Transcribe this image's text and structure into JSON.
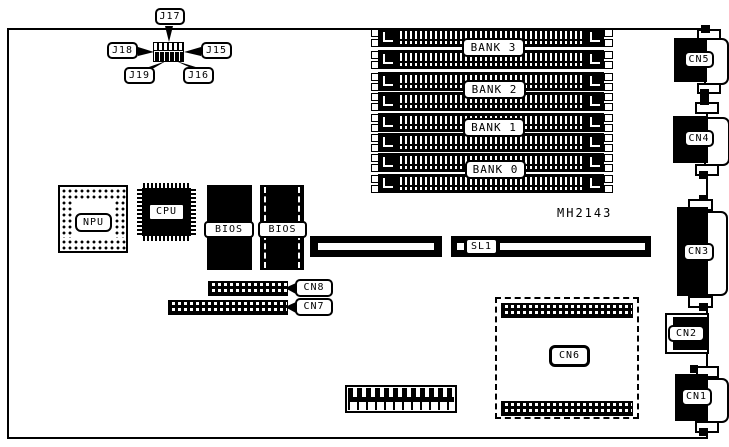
{
  "board": {
    "part_number": "MH2143",
    "jumpers": {
      "j15": "J15",
      "j16": "J16",
      "j17": "J17",
      "j18": "J18",
      "j19": "J19"
    },
    "chips": {
      "npu": "NPU",
      "cpu": "CPU",
      "bios_left": "BIOS",
      "bios_right": "BIOS"
    },
    "memory": {
      "bank0": "BANK 0",
      "bank1": "BANK 1",
      "bank2": "BANK 2",
      "bank3": "BANK 3"
    },
    "slot": {
      "sl1": "SL1"
    },
    "connectors": {
      "cn1": "CN1",
      "cn2": "CN2",
      "cn3": "CN3",
      "cn4": "CN4",
      "cn5": "CN5",
      "cn6": "CN6",
      "cn7": "CN7",
      "cn8": "CN8"
    },
    "colors": {
      "ink": "#000000",
      "paper": "#ffffff"
    }
  }
}
